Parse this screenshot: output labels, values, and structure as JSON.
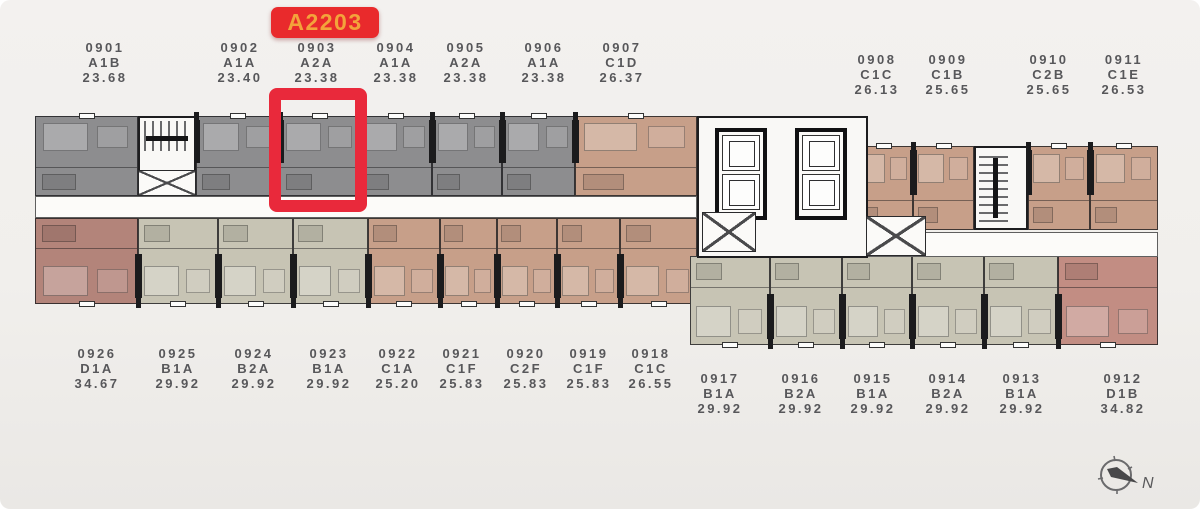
{
  "badge": {
    "label": "A2203"
  },
  "compass": {
    "label": "N"
  },
  "palette": {
    "gray": "#8d8d8f",
    "tan": "#c79f89",
    "olive": "#c7c4b4",
    "red_brown": "#b3847a",
    "pink": "#c28d83",
    "corridor_white": "#fcfbf9",
    "wall_black": "#1d1d1f",
    "highlight_red": "#e9293b",
    "badge_red": "#e92a2c",
    "badge_orange": "#f3a33b",
    "label_text": "#57575a",
    "background": "#f1efec"
  },
  "floorplan": {
    "rows": {
      "tl": {
        "y": 116,
        "h": 80,
        "outer": "top"
      },
      "tr": {
        "y": 146,
        "h": 84,
        "outer": "top"
      },
      "bl": {
        "y": 218,
        "h": 86,
        "outer": "bottom"
      },
      "br": {
        "y": 256,
        "h": 89,
        "outer": "bottom"
      }
    },
    "units": [
      {
        "code": "0901",
        "type": "A1B",
        "area": "23.68",
        "color": "gray",
        "row": "tl",
        "x": 35,
        "w": 103,
        "label_cx": 105,
        "label_y": 40,
        "highlighted": false
      },
      {
        "code": "0902",
        "type": "A1A",
        "area": "23.40",
        "color": "gray",
        "row": "tl",
        "x": 196,
        "w": 84,
        "label_cx": 240,
        "label_y": 40,
        "highlighted": false
      },
      {
        "code": "0903",
        "type": "A2A",
        "area": "23.38",
        "color": "gray",
        "row": "tl",
        "x": 280,
        "w": 80,
        "label_cx": 317,
        "label_y": 40,
        "highlighted": true
      },
      {
        "code": "0904",
        "type": "A1A",
        "area": "23.38",
        "color": "gray",
        "row": "tl",
        "x": 360,
        "w": 72,
        "label_cx": 396,
        "label_y": 40,
        "highlighted": false
      },
      {
        "code": "0905",
        "type": "A2A",
        "area": "23.38",
        "color": "gray",
        "row": "tl",
        "x": 432,
        "w": 70,
        "label_cx": 466,
        "label_y": 40,
        "highlighted": false
      },
      {
        "code": "0906",
        "type": "A1A",
        "area": "23.38",
        "color": "gray",
        "row": "tl",
        "x": 502,
        "w": 73,
        "label_cx": 544,
        "label_y": 40,
        "highlighted": false
      },
      {
        "code": "0907",
        "type": "C1D",
        "area": "26.37",
        "color": "tan",
        "row": "tl",
        "x": 575,
        "w": 122,
        "label_cx": 622,
        "label_y": 40,
        "highlighted": false
      },
      {
        "code": "0908",
        "type": "C1C",
        "area": "26.13",
        "color": "tan",
        "row": "tr",
        "x": 855,
        "w": 58,
        "label_cx": 877,
        "label_y": 52,
        "highlighted": false
      },
      {
        "code": "0909",
        "type": "C1B",
        "area": "25.65",
        "color": "tan",
        "row": "tr",
        "x": 913,
        "w": 61,
        "label_cx": 948,
        "label_y": 52,
        "highlighted": false
      },
      {
        "code": "0910",
        "type": "C2B",
        "area": "25.65",
        "color": "tan",
        "row": "tr",
        "x": 1028,
        "w": 62,
        "label_cx": 1049,
        "label_y": 52,
        "highlighted": false
      },
      {
        "code": "0911",
        "type": "C1E",
        "area": "26.53",
        "color": "tan",
        "row": "tr",
        "x": 1090,
        "w": 68,
        "label_cx": 1124,
        "label_y": 52,
        "highlighted": false
      },
      {
        "code": "0926",
        "type": "D1A",
        "area": "34.67",
        "color": "red_brown",
        "row": "bl",
        "x": 35,
        "w": 103,
        "label_cx": 97,
        "label_y": 346,
        "highlighted": false
      },
      {
        "code": "0925",
        "type": "B1A",
        "area": "29.92",
        "color": "olive",
        "row": "bl",
        "x": 138,
        "w": 80,
        "label_cx": 178,
        "label_y": 346,
        "highlighted": false
      },
      {
        "code": "0924",
        "type": "B2A",
        "area": "29.92",
        "color": "olive",
        "row": "bl",
        "x": 218,
        "w": 75,
        "label_cx": 254,
        "label_y": 346,
        "highlighted": false
      },
      {
        "code": "0923",
        "type": "B1A",
        "area": "29.92",
        "color": "olive",
        "row": "bl",
        "x": 293,
        "w": 75,
        "label_cx": 329,
        "label_y": 346,
        "highlighted": false
      },
      {
        "code": "0922",
        "type": "C1A",
        "area": "25.20",
        "color": "tan",
        "row": "bl",
        "x": 368,
        "w": 72,
        "label_cx": 398,
        "label_y": 346,
        "highlighted": false
      },
      {
        "code": "0921",
        "type": "C1F",
        "area": "25.83",
        "color": "tan",
        "row": "bl",
        "x": 440,
        "w": 57,
        "label_cx": 462,
        "label_y": 346,
        "highlighted": false
      },
      {
        "code": "0920",
        "type": "C2F",
        "area": "25.83",
        "color": "tan",
        "row": "bl",
        "x": 497,
        "w": 60,
        "label_cx": 526,
        "label_y": 346,
        "highlighted": false
      },
      {
        "code": "0919",
        "type": "C1F",
        "area": "25.83",
        "color": "tan",
        "row": "bl",
        "x": 557,
        "w": 63,
        "label_cx": 589,
        "label_y": 346,
        "highlighted": false
      },
      {
        "code": "0918",
        "type": "C1C",
        "area": "26.55",
        "color": "tan",
        "row": "bl",
        "x": 620,
        "w": 77,
        "label_cx": 651,
        "label_y": 346,
        "highlighted": false
      },
      {
        "code": "0917",
        "type": "B1A",
        "area": "29.92",
        "color": "olive",
        "row": "br",
        "x": 690,
        "w": 80,
        "label_cx": 720,
        "label_y": 371,
        "highlighted": false
      },
      {
        "code": "0916",
        "type": "B2A",
        "area": "29.92",
        "color": "olive",
        "row": "br",
        "x": 770,
        "w": 72,
        "label_cx": 801,
        "label_y": 371,
        "highlighted": false
      },
      {
        "code": "0915",
        "type": "B1A",
        "area": "29.92",
        "color": "olive",
        "row": "br",
        "x": 842,
        "w": 70,
        "label_cx": 873,
        "label_y": 371,
        "highlighted": false
      },
      {
        "code": "0914",
        "type": "B2A",
        "area": "29.92",
        "color": "olive",
        "row": "br",
        "x": 912,
        "w": 72,
        "label_cx": 948,
        "label_y": 371,
        "highlighted": false
      },
      {
        "code": "0913",
        "type": "B1A",
        "area": "29.92",
        "color": "olive",
        "row": "br",
        "x": 984,
        "w": 74,
        "label_cx": 1022,
        "label_y": 371,
        "highlighted": false
      },
      {
        "code": "0912",
        "type": "D1B",
        "area": "34.82",
        "color": "pink",
        "row": "br",
        "x": 1058,
        "w": 100,
        "label_cx": 1123,
        "label_y": 371,
        "highlighted": false
      }
    ],
    "corridors": [
      {
        "x": 35,
        "y": 196,
        "w": 662,
        "h": 22
      },
      {
        "x": 860,
        "y": 232,
        "w": 298,
        "h": 25
      }
    ],
    "cores": [
      {
        "kind": "stair-v",
        "x": 138,
        "y": 116,
        "w": 58,
        "h": 56
      },
      {
        "kind": "xshaft",
        "x": 138,
        "y": 170,
        "w": 58,
        "h": 26
      },
      {
        "kind": "elev",
        "x": 697,
        "y": 116,
        "w": 171,
        "h": 142
      },
      {
        "kind": "xshaft",
        "x": 702,
        "y": 212,
        "w": 54,
        "h": 40
      },
      {
        "kind": "xshaft",
        "x": 866,
        "y": 216,
        "w": 60,
        "h": 40
      },
      {
        "kind": "stair-h",
        "x": 974,
        "y": 146,
        "w": 54,
        "h": 84
      }
    ]
  }
}
